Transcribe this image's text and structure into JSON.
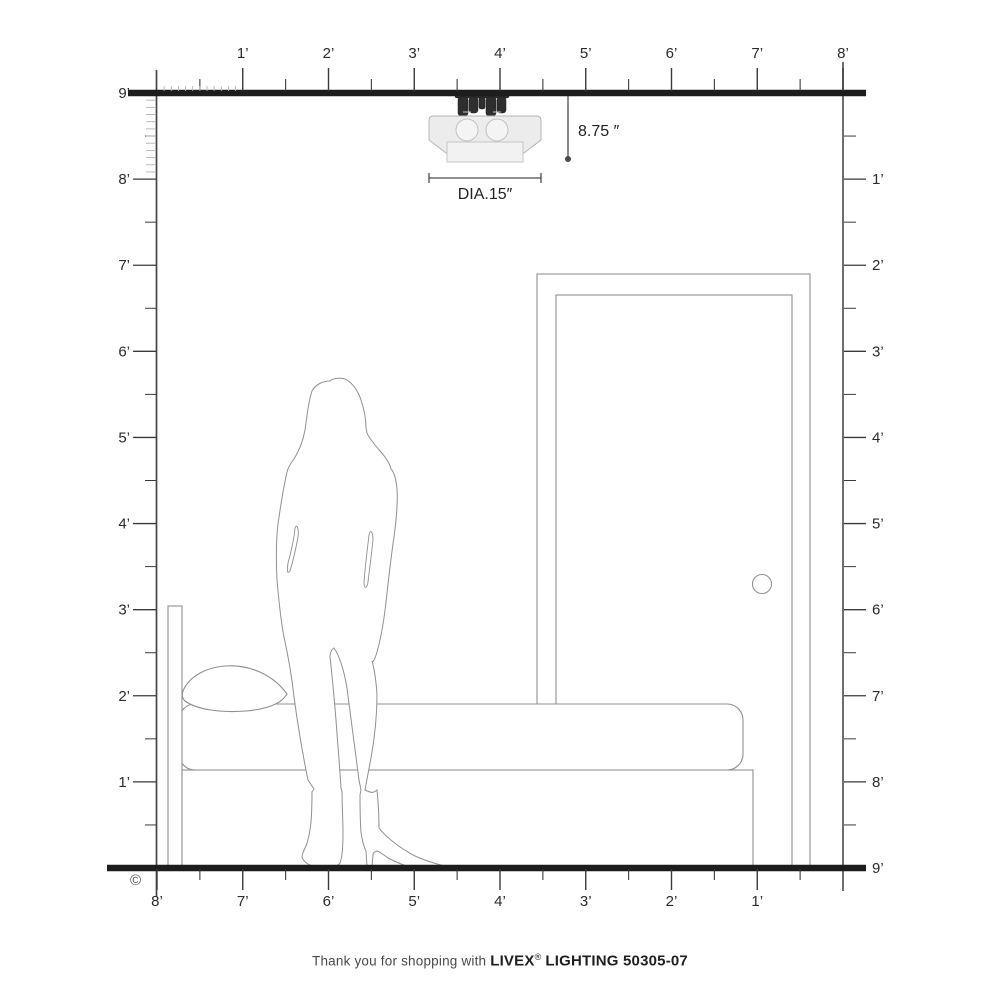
{
  "diagram": {
    "copyright": "©",
    "fixture": {
      "height_label": "8.75 ″",
      "diameter_label": "DIA.15″"
    },
    "rulers": {
      "top_labels": [
        "1’",
        "2’",
        "3’",
        "4’",
        "5’",
        "6’",
        "7’",
        "8’"
      ],
      "left_labels": [
        "9’",
        "8’",
        "7’",
        "6’",
        "5’",
        "4’",
        "3’",
        "2’",
        "1’"
      ],
      "right_labels": [
        "1’",
        "2’",
        "3’",
        "4’",
        "5’",
        "6’",
        "7’",
        "8’",
        "9’"
      ],
      "bottom_labels": [
        "8’",
        "7’",
        "6’",
        "5’",
        "4’",
        "3’",
        "2’",
        "1’"
      ],
      "feet_horizontal": 8,
      "feet_vertical": 9
    },
    "scene_objects": [
      "ceiling-light-fixture",
      "standing-woman",
      "bed",
      "door"
    ],
    "footer": {
      "message": "Thank you for shopping with",
      "brand": "LIVEX",
      "registered_mark": "®",
      "product": "LIGHTING 50305-07"
    },
    "colors": {
      "frame": "#1d1d1d",
      "ticks": "#3a3a3a",
      "fine_ticks": "#b4b4b4",
      "sketch_lines": "#8f8f8f",
      "fixture_dark": "#2e2e2e",
      "glass_fill": "#ececec",
      "dimension_lines": "#4a4a4a",
      "label_text": "#2b2b2b"
    }
  }
}
